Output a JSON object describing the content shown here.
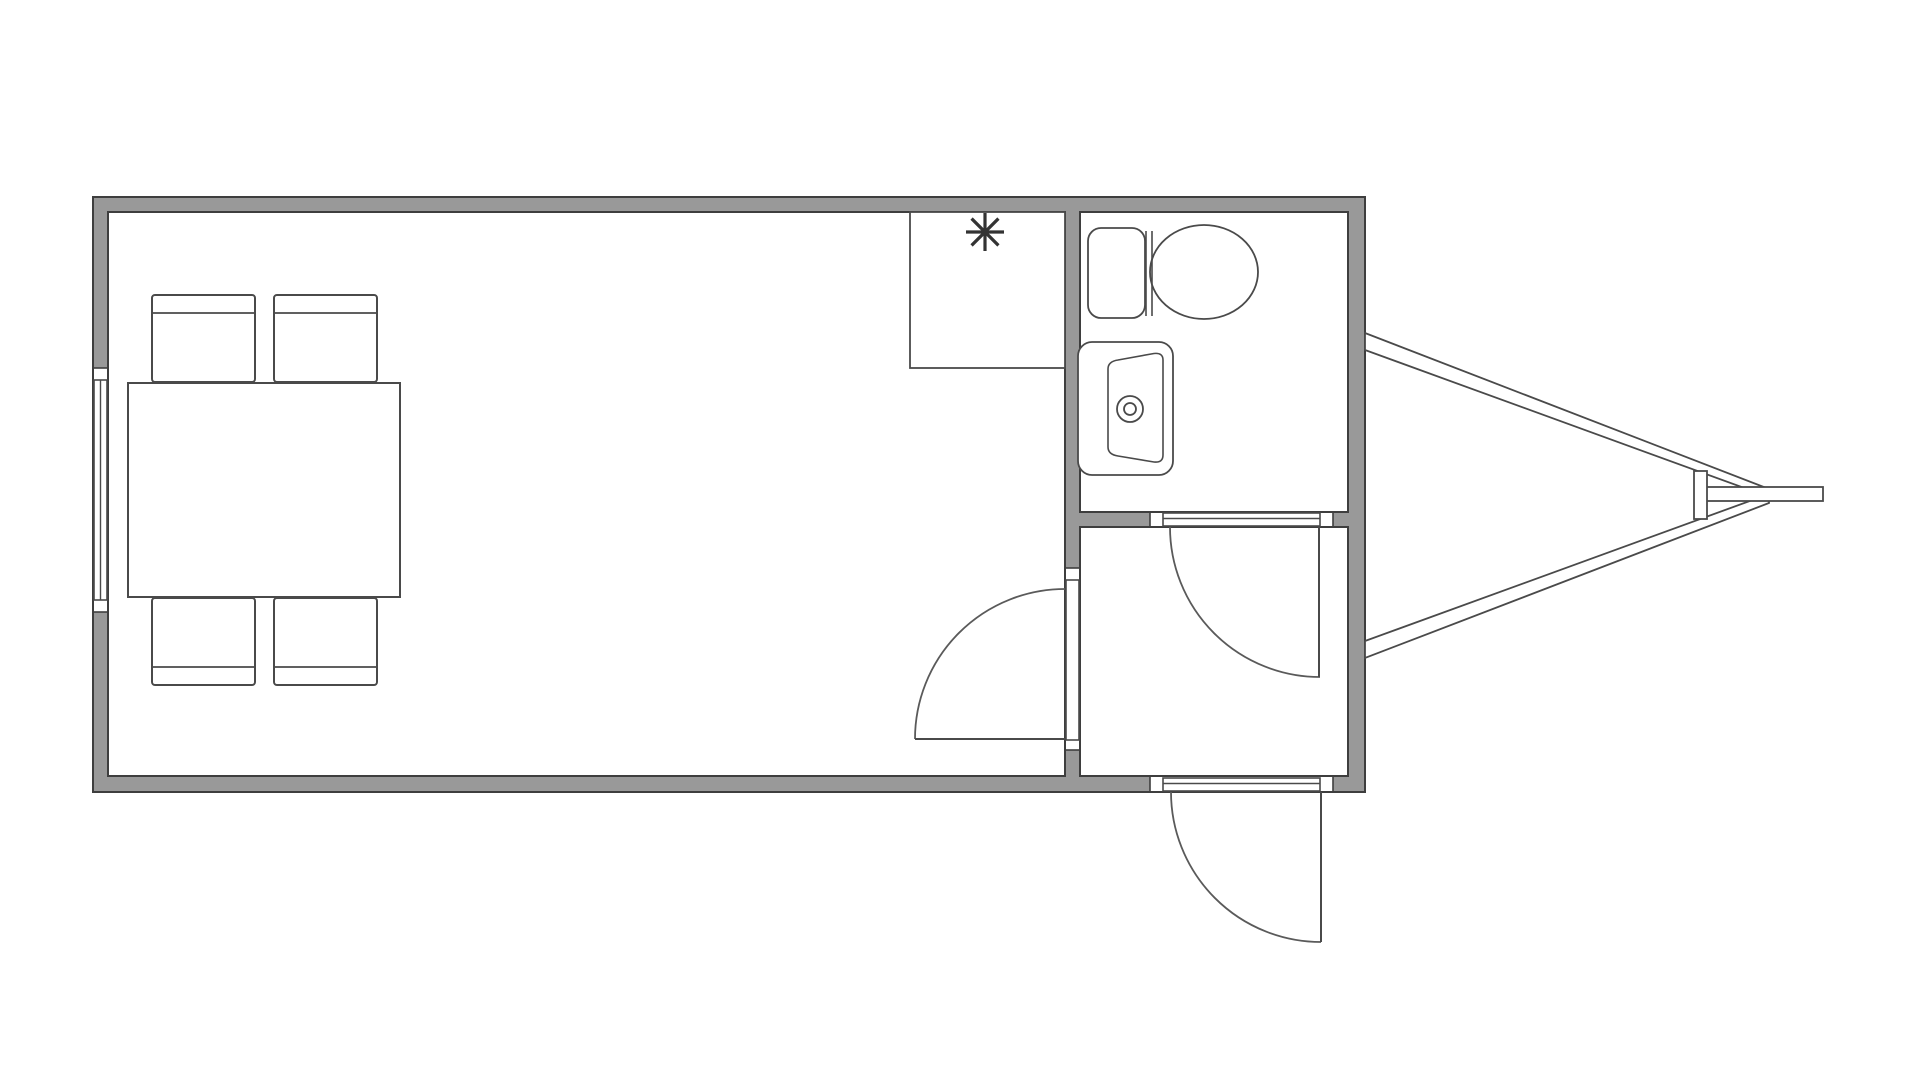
{
  "meta": {
    "title": "Trailer floor plan",
    "diagram_type": "floor-plan"
  },
  "canvas": {
    "width": 1920,
    "height": 1080,
    "background": "#ffffff"
  },
  "style": {
    "wall_fill": "#999999",
    "wall_line": "#3e3e3e",
    "thin_line": "#4a4a4a",
    "arc_line": "#5a5a5a",
    "symbol_color": "#333333",
    "fixture_fill": "#ffffff",
    "wall_stroke_w": 2,
    "thin_stroke_w": 2,
    "arc_stroke_w": 1.8
  },
  "rooms": [
    {
      "name": "main-room",
      "label": ""
    },
    {
      "name": "bathroom",
      "label": ""
    },
    {
      "name": "entry-room",
      "label": ""
    }
  ],
  "walls": [
    {
      "name": "wall-top",
      "x": 93,
      "y": 197,
      "w": 1272,
      "h": 15
    },
    {
      "name": "wall-left-upper",
      "x": 93,
      "y": 197,
      "w": 15,
      "h": 171
    },
    {
      "name": "wall-left-lower",
      "x": 93,
      "y": 612,
      "w": 15,
      "h": 180
    },
    {
      "name": "wall-bottom-left",
      "x": 93,
      "y": 777,
      "w": 1057,
      "h": 15
    },
    {
      "name": "wall-bottom-right",
      "x": 1333,
      "y": 777,
      "w": 32,
      "h": 15
    },
    {
      "name": "wall-right",
      "x": 1348,
      "y": 197,
      "w": 17,
      "h": 595
    },
    {
      "name": "wall-partition-upper",
      "x": 1065,
      "y": 197,
      "w": 15,
      "h": 371
    },
    {
      "name": "wall-partition-lower",
      "x": 1065,
      "y": 750,
      "w": 15,
      "h": 27
    },
    {
      "name": "wall-bath-bottom-left",
      "x": 1065,
      "y": 512,
      "w": 85,
      "h": 15
    },
    {
      "name": "wall-bath-bottom-right",
      "x": 1333,
      "y": 512,
      "w": 15,
      "h": 15
    }
  ],
  "outlines": [
    {
      "name": "outline-exterior",
      "x": 93,
      "y": 197,
      "w": 1272,
      "h": 595
    },
    {
      "name": "outline-main-room",
      "x": 108,
      "y": 212,
      "w": 957,
      "h": 564
    },
    {
      "name": "outline-bathroom",
      "x": 1080,
      "y": 212,
      "w": 268,
      "h": 300
    },
    {
      "name": "outline-entry-room",
      "x": 1080,
      "y": 527,
      "w": 268,
      "h": 249
    }
  ],
  "cut_lines": [
    {
      "x1": 93,
      "y1": 368,
      "x2": 108,
      "y2": 368
    },
    {
      "x1": 93,
      "y1": 612,
      "x2": 108,
      "y2": 612
    },
    {
      "x1": 1065,
      "y1": 568,
      "x2": 1080,
      "y2": 568
    },
    {
      "x1": 1065,
      "y1": 750,
      "x2": 1080,
      "y2": 750
    },
    {
      "x1": 1150,
      "y1": 512,
      "x2": 1150,
      "y2": 527
    },
    {
      "x1": 1333,
      "y1": 512,
      "x2": 1333,
      "y2": 527
    },
    {
      "x1": 1150,
      "y1": 777,
      "x2": 1150,
      "y2": 792
    },
    {
      "x1": 1333,
      "y1": 777,
      "x2": 1333,
      "y2": 792
    }
  ],
  "window": {
    "name": "window-left-wall",
    "band": {
      "x": 94,
      "y": 380,
      "w": 13,
      "h": 220
    },
    "mid_line": {
      "x1": 100.5,
      "y1": 380,
      "x2": 100.5,
      "y2": 600
    }
  },
  "openings": [
    {
      "name": "doorway-main-room",
      "x": 1066,
      "y": 580,
      "w": 13,
      "h": 160,
      "inner_line": null
    },
    {
      "name": "doorway-bathroom",
      "x": 1163,
      "y": 513,
      "w": 157,
      "h": 13,
      "inner_line": {
        "x1": 1163,
        "y1": 518.5,
        "x2": 1320,
        "y2": 518.5
      }
    },
    {
      "name": "doorway-exterior",
      "x": 1163,
      "y": 778,
      "w": 157,
      "h": 13,
      "inner_line": {
        "x1": 1163,
        "y1": 783.5,
        "x2": 1320,
        "y2": 783.5
      }
    }
  ],
  "doors": [
    {
      "name": "door-main-room",
      "leaf": {
        "x1": 915,
        "y1": 739,
        "x2": 1065,
        "y2": 739
      },
      "arc_path": "M 915 739 A 150 150 0 0 1 1065 589"
    },
    {
      "name": "door-bathroom",
      "leaf": {
        "x1": 1319,
        "y1": 527,
        "x2": 1319,
        "y2": 677
      },
      "arc_path": "M 1170 527 A 150 150 0 0 0 1320 677"
    },
    {
      "name": "door-exterior",
      "leaf": {
        "x1": 1321,
        "y1": 792,
        "x2": 1321,
        "y2": 942
      },
      "arc_path": "M 1171 792 A 150 150 0 0 0 1321 942"
    }
  ],
  "dining_set": {
    "table": {
      "name": "dining-table",
      "x": 128,
      "y": 383,
      "w": 272,
      "h": 214
    },
    "chair_size": {
      "w": 103,
      "h": 87
    },
    "chairs": [
      {
        "name": "chair-top-left",
        "x": 152,
        "y": 295,
        "back_line_y": 313
      },
      {
        "name": "chair-top-right",
        "x": 274,
        "y": 295,
        "back_line_y": 313
      },
      {
        "name": "chair-bottom-left",
        "x": 152,
        "y": 598,
        "back_line_y": 667
      },
      {
        "name": "chair-bottom-right",
        "x": 274,
        "y": 598,
        "back_line_y": 667
      }
    ]
  },
  "counter": {
    "name": "kitchen-counter",
    "x": 910,
    "y": 212,
    "w": 155,
    "h": 156
  },
  "fixture_symbol": {
    "name": "asterisk-fixture-symbol",
    "cx": 985,
    "cy": 232,
    "r": 19,
    "spokes": 8,
    "stroke_w": 3.2
  },
  "toilet": {
    "name": "toilet",
    "tank": {
      "x": 1088,
      "y": 228,
      "w": 57,
      "h": 90,
      "rx": 13
    },
    "divider_lines": [
      {
        "x1": 1146,
        "y1": 231,
        "x2": 1146,
        "y2": 316
      },
      {
        "x1": 1152,
        "y1": 231,
        "x2": 1152,
        "y2": 316
      }
    ],
    "bowl": {
      "cx": 1204,
      "cy": 272,
      "rx": 54,
      "ry": 47
    }
  },
  "sink": {
    "name": "bathroom-sink",
    "vanity": {
      "x": 1078,
      "y": 342,
      "w": 95,
      "h": 133,
      "rx": 14
    },
    "basin_path": "M 1118 360 L 1154 353.5 Q 1163 352.5 1163 360 L 1163 455 Q 1163 463 1154 462 L 1118 456 Q 1108 454.5 1108 447 L 1108 369 Q 1108 361.5 1118 360 Z",
    "faucet": {
      "cx": 1130,
      "cy": 409,
      "r_outer": 13,
      "r_inner": 6
    }
  },
  "hitch": {
    "name": "trailer-hitch",
    "upper_bar": "1365,333 1769,489 1769,497 1365,350",
    "lower_bar": "1365,641 1769,494 1769,503 1365,658",
    "tongue": {
      "x": 1700,
      "y": 487,
      "w": 123,
      "h": 14
    },
    "jack_bar": {
      "x": 1694,
      "y": 471,
      "w": 13,
      "h": 48
    }
  }
}
